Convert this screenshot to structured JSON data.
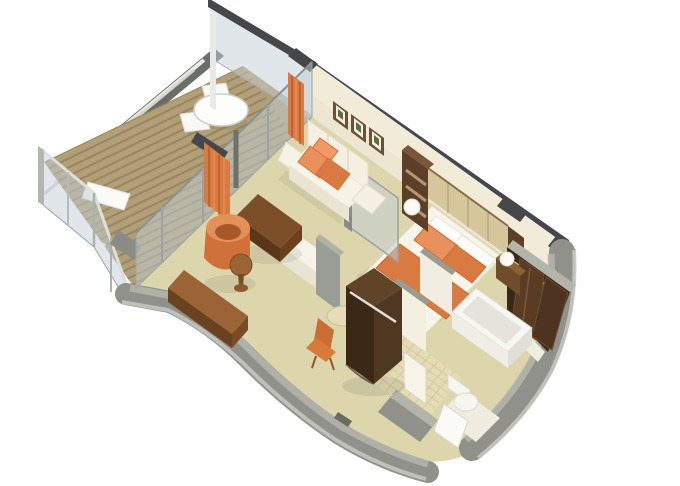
{
  "palette": {
    "background": "#ffffff",
    "floor": "#ddd6ad",
    "deck": "#b29f77",
    "deck_stripe": "#93825f",
    "wall_cream": "#f1ebd7",
    "wall_cap": "#45474a",
    "outer_wall": "#8f918a",
    "outer_wall_cap": "#b3b5ab",
    "glass": "#c1ced5",
    "glass_frame": "#9aa4a6",
    "orange": "#d97a42",
    "orange_light": "#e8915c",
    "orange_dark": "#c4682f",
    "wood_dark": "#3b2918",
    "wood_medium": "#6e4c2c",
    "wood_light": "#9a6436",
    "white_furniture": "#f6f3e8",
    "tile": "#e5dcb6",
    "headboard": "#d5c69c"
  },
  "scene": {
    "view": "isometric-cutaway-suite-floorplan",
    "rooms": [
      {
        "name": "balcony",
        "items": [
          "wood-plank-deck",
          "glass-railing",
          "privacy-divider-glass",
          "round-table",
          "deck-chairs",
          "lounger"
        ]
      },
      {
        "name": "living-room",
        "items": [
          "sofa",
          "orange-throw-pillows",
          "wall-art-frames",
          "ottoman",
          "tub-chair",
          "ball-side-table",
          "desk",
          "desk-chair",
          "orange-curtains",
          "sliding-glass-doors"
        ]
      },
      {
        "name": "bedroom",
        "items": [
          "double-bed",
          "orange-bed-runner",
          "orange-pillows",
          "padded-headboard",
          "wall-art-frames",
          "nightstand",
          "table-lamps",
          "shelf-column",
          "tv-cabinet",
          "glass-partition",
          "vanity-table"
        ]
      },
      {
        "name": "bathroom",
        "items": [
          "bathtub",
          "toilet",
          "tiled-floor",
          "partition-walls",
          "door-frame"
        ]
      },
      {
        "name": "entry",
        "items": [
          "entry-door",
          "wardrobe-closet",
          "hallway-threshold"
        ]
      }
    ]
  }
}
